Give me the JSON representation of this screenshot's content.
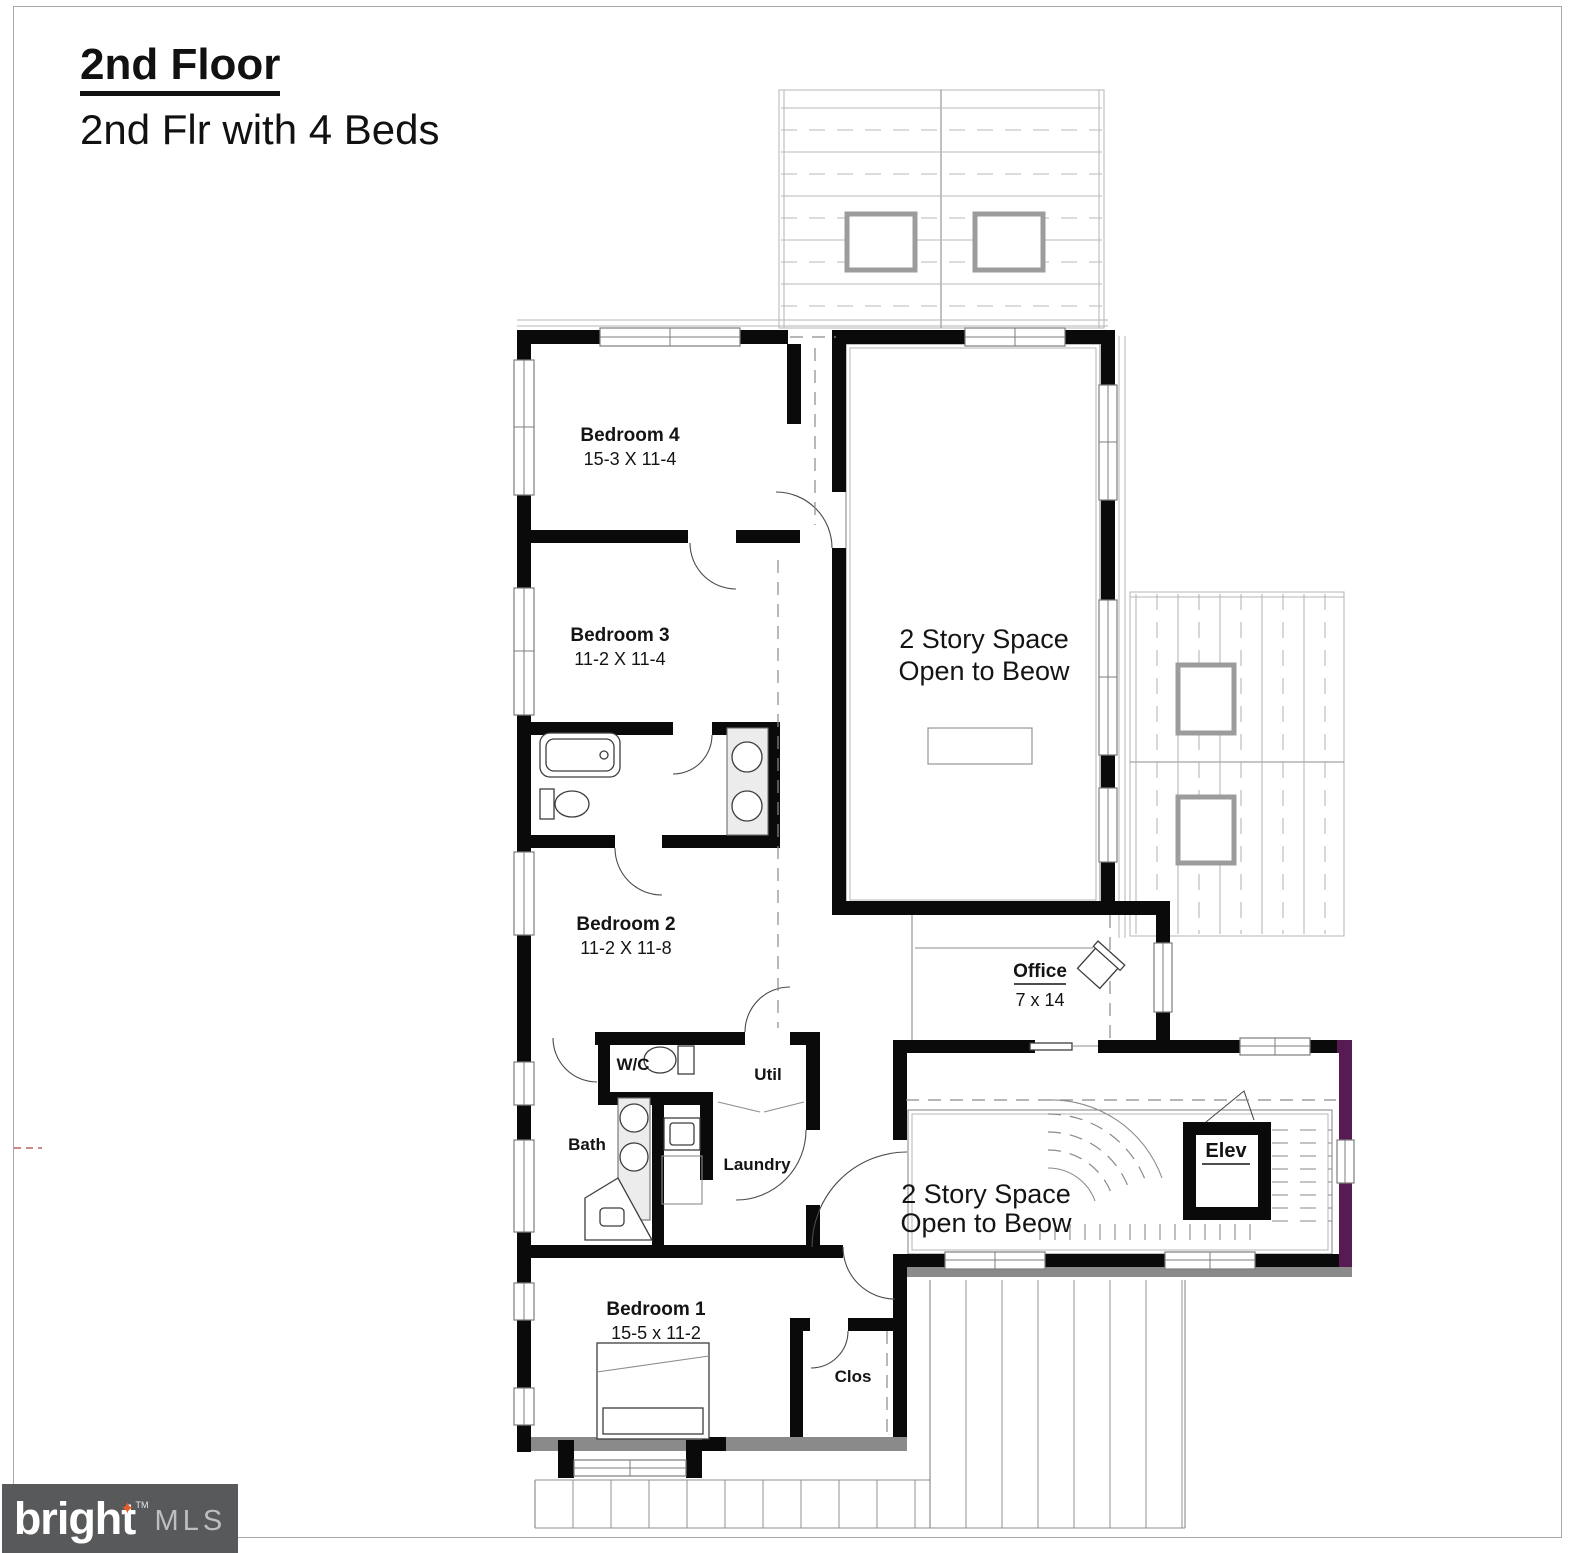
{
  "title": {
    "heading": "2nd Floor",
    "subheading": "2nd Flr with 4 Beds"
  },
  "rooms": {
    "bedroom4": {
      "name": "Bedroom 4",
      "dims": "15-3 X 11-4"
    },
    "bedroom3": {
      "name": "Bedroom 3",
      "dims": "11-2 X 11-4"
    },
    "bedroom2": {
      "name": "Bedroom 2",
      "dims": "11-2 X 11-8"
    },
    "bedroom1": {
      "name": "Bedroom 1",
      "dims": "15-5 x 11-2"
    },
    "office": {
      "name": "Office",
      "dims": "7 x 14"
    },
    "two_story_upper": {
      "line1": "2 Story Space",
      "line2": "Open to Beow"
    },
    "two_story_lower": {
      "line1": "2 Story Space",
      "line2": "Open to Beow"
    },
    "wc": {
      "name": "W/C"
    },
    "util": {
      "name": "Util"
    },
    "bath": {
      "name": "Bath"
    },
    "laundry": {
      "name": "Laundry"
    },
    "elev": {
      "name": "Elev"
    },
    "clos": {
      "name": "Clos"
    }
  },
  "logo": {
    "brand": "bright",
    "trademark": "TM",
    "suffix": "MLS"
  },
  "colors": {
    "wall_black": "#0a0a0a",
    "accent_purple": "#581a52",
    "logo_background": "#58595b",
    "logo_star_orange": "#e65c25",
    "logo_text_white": "#ffffff",
    "logo_suffix_gray": "#bcbec0"
  }
}
